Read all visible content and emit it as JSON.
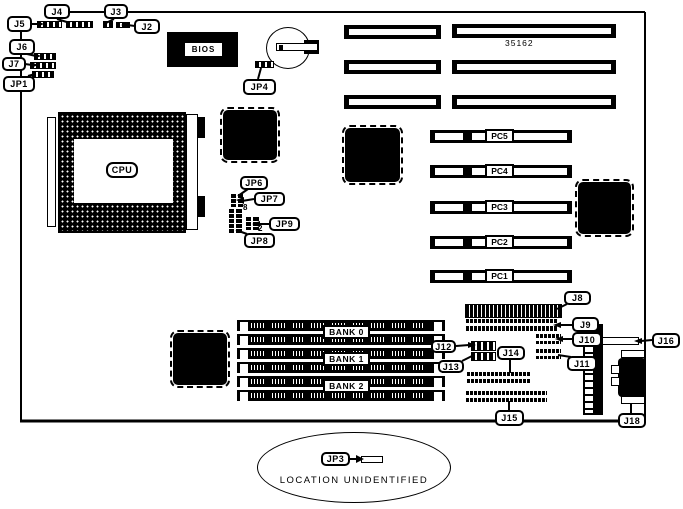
{
  "board": {
    "part_number": "35162",
    "note": "LOCATION UNIDENTIFIED"
  },
  "chips": {
    "cpu": "CPU",
    "bios": "BIOS"
  },
  "callouts": {
    "j2": "J2",
    "j3": "J3",
    "j4": "J4",
    "j5": "J5",
    "j6": "J6",
    "j7": "J7",
    "jp1": "JP1",
    "jp3": "JP3",
    "jp4": "JP4",
    "jp6": "JP6",
    "jp7": "JP7",
    "jp8": "JP8",
    "jp9": "JP9",
    "j8": "J8",
    "j9": "J9",
    "j10": "J10",
    "j11": "J11",
    "j12": "J12",
    "j13": "J13",
    "j14": "J14",
    "j15": "J15",
    "j16": "J16",
    "j18": "J18"
  },
  "memory_banks": [
    "BANK 0",
    "BANK 1",
    "BANK 2"
  ],
  "pc_slots": [
    "PC5",
    "PC4",
    "PC3",
    "PC2",
    "PC1"
  ],
  "jumper_pins": {
    "jp8_pin": "8",
    "jp9_pin": "2"
  },
  "colors": {
    "ink": "#000000",
    "background": "#ffffff"
  }
}
